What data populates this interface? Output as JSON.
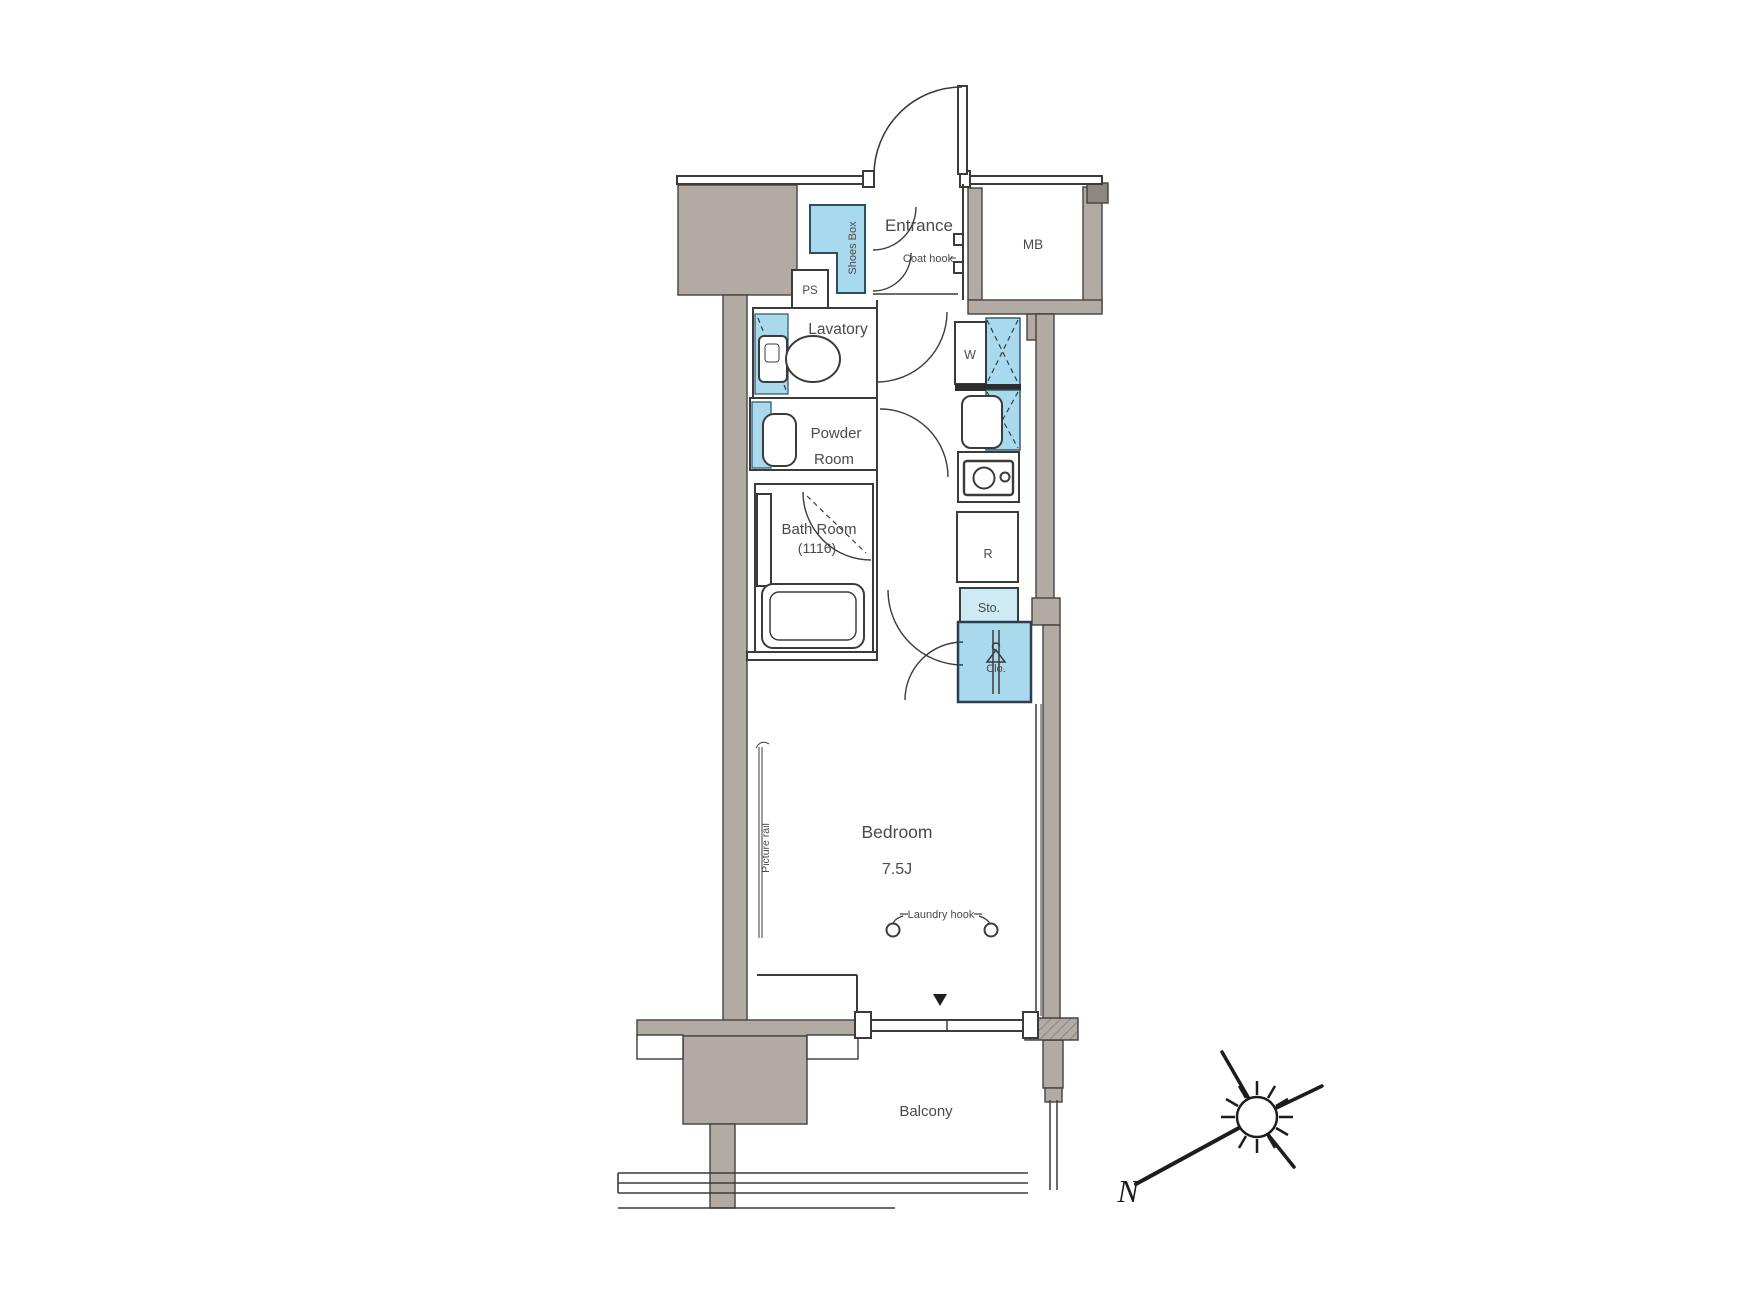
{
  "plan": {
    "entrance_label": "Entrance",
    "coat_hook_label": "Coat hook",
    "shoes_box_label": "Shoes Box",
    "meter_box_label": "MB",
    "pipe_space_label": "PS",
    "lavatory_label": "Lavatory",
    "powder_room_label_line1": "Powder",
    "powder_room_label_line2": "Room",
    "bath_room_label": "Bath Room",
    "bath_room_size_label": "(1116)",
    "washing_machine_label": "W",
    "refrigerator_label": "R",
    "storage_label": "Sto.",
    "closet_label": "Clo.",
    "bedroom_label": "Bedroom",
    "bedroom_size_label": "7.5J",
    "laundry_hook_label": "Laundry hook",
    "picture_rail_label": "Picture rail",
    "balcony_label": "Balcony",
    "compass_north_label": "N"
  },
  "colors": {
    "wall_fill": "#b2aba3",
    "wall_cap_fill": "#8d8780",
    "fixture_blue": "#a9d9ec",
    "storage_blue": "#cdeaf5",
    "line": "#3b3b3b",
    "text": "#4a4a4a"
  }
}
